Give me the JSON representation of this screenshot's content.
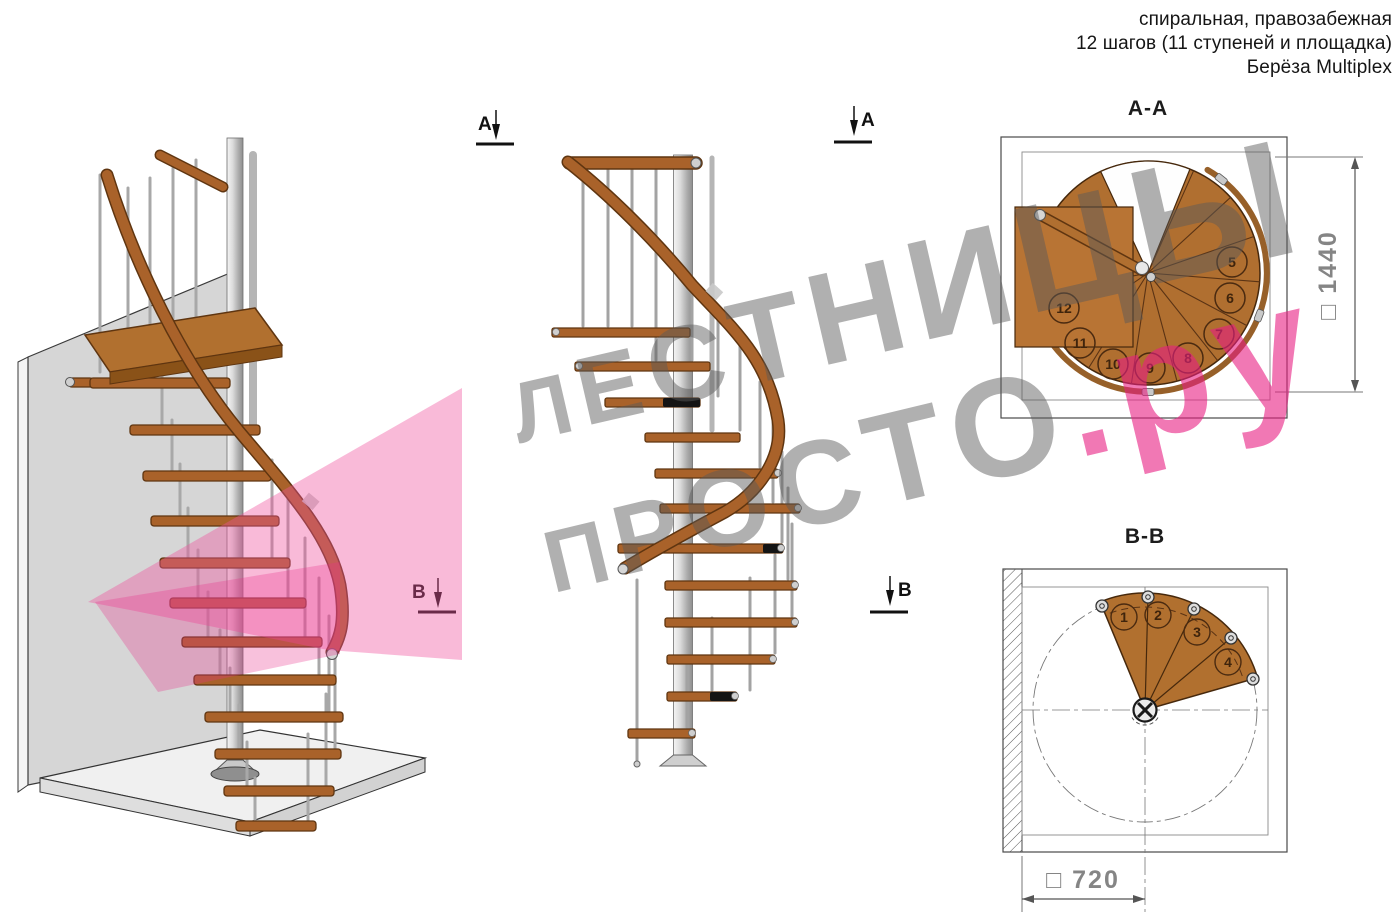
{
  "header": {
    "line1": "спиральная, правозабежная",
    "line2": "12 шагов (11 ступеней и площадка)",
    "line3": "Берёза Multiplex"
  },
  "watermark": {
    "line1": "ЛЕСТНИЦЫ",
    "line2_gray": "ПРОСТО",
    "line2_pink": ".ру",
    "gray_color": "#8a8a8a",
    "pink_color": "#e81e82"
  },
  "sections": {
    "a_label": "А",
    "b_label": "В"
  },
  "plan_aa": {
    "title": "А-А",
    "dimension": "□ 1440",
    "steps": [
      "5",
      "6",
      "7",
      "8",
      "9",
      "10",
      "11",
      "12"
    ]
  },
  "plan_bb": {
    "title": "В-В",
    "dimension": "□ 720",
    "steps": [
      "1",
      "2",
      "3",
      "4"
    ]
  },
  "colors": {
    "wood": "#a9622a",
    "wood_dark": "#5f3510",
    "steel": "#c9c9c9",
    "highlight_pink": "#f0529e"
  }
}
